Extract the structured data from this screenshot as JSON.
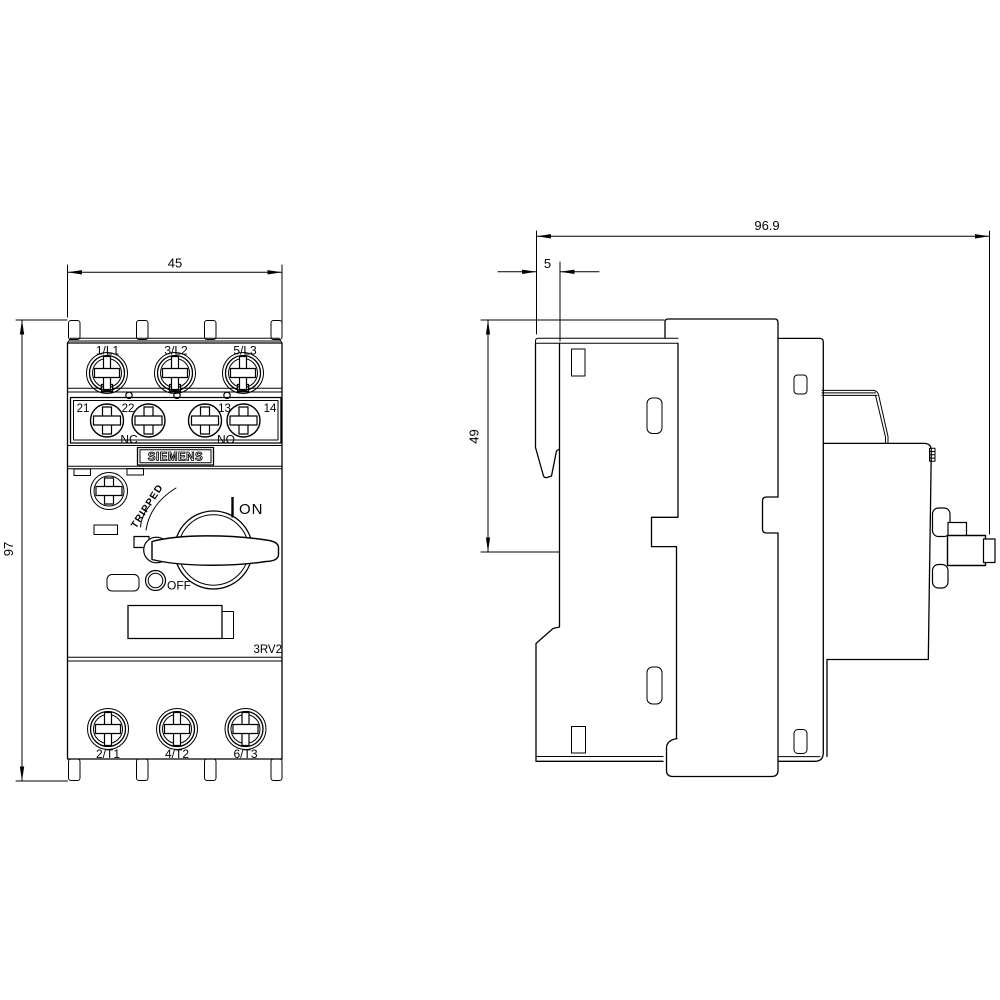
{
  "drawing": {
    "title": "Siemens 3RV2 motor starter protector dimensional drawing",
    "brand": "SIEMENS",
    "model": "3RV2",
    "front_view": {
      "dim_width": "45",
      "dim_height": "97",
      "terminals_top": [
        "1/L1",
        "3/L2",
        "5/L3"
      ],
      "aux_terminals": [
        "21",
        "22",
        "13",
        "14"
      ],
      "aux_contact_nc": "NC",
      "aux_contact_no": "NO",
      "switch": {
        "tripped": "TRIPPED",
        "on": "ON",
        "off": "OFF"
      },
      "terminals_bottom": [
        "2/T1",
        "4/T2",
        "6/T3"
      ]
    },
    "side_view": {
      "dim_depth": "96.9",
      "dim_clip_depth": "5",
      "dim_upper_height": "49"
    },
    "line_color": "#000000",
    "background_color": "#ffffff"
  }
}
